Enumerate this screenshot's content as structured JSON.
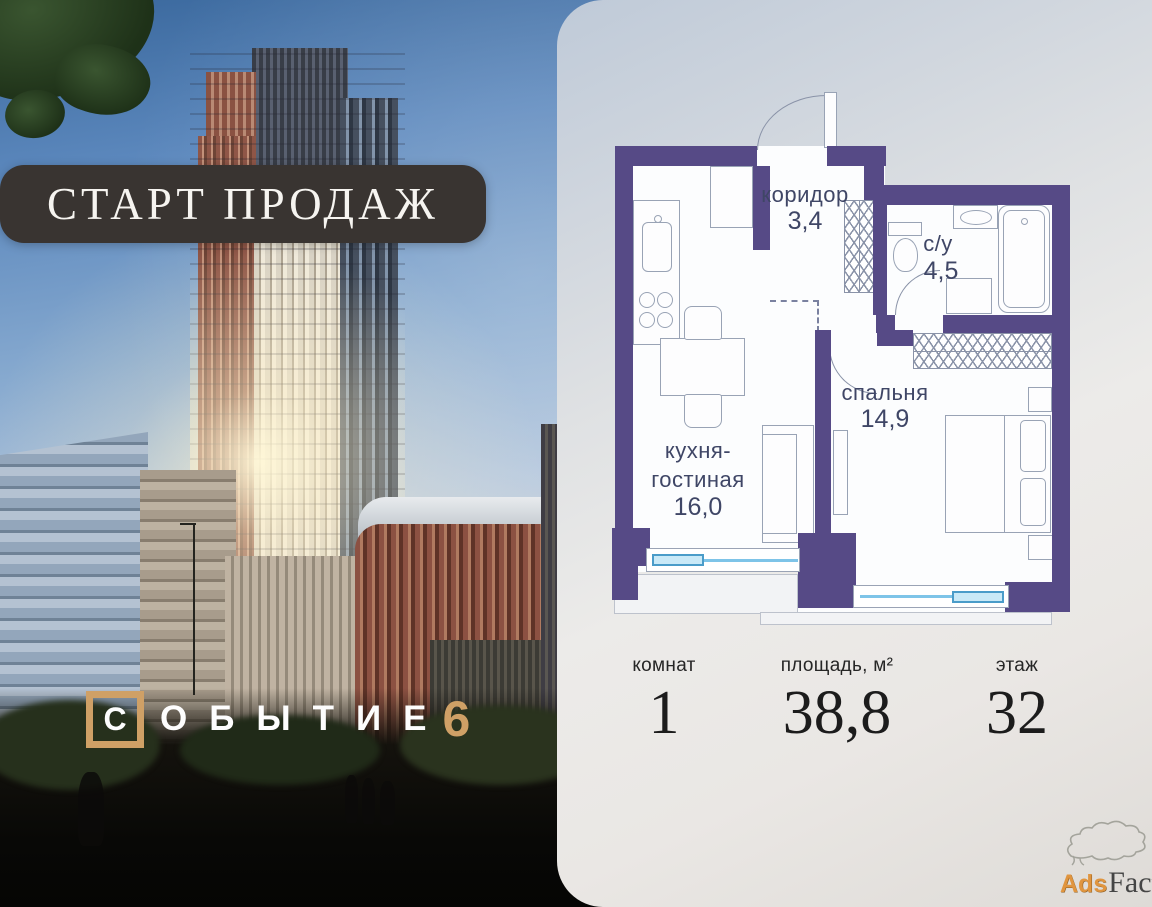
{
  "banner": {
    "text": "СТАРТ ПРОДАЖ"
  },
  "logo": {
    "first_letter": "С",
    "rest": "ОБЫТИЕ",
    "number": "6"
  },
  "floor_plan": {
    "rooms": {
      "corridor": {
        "name": "коридор",
        "area": "3,4"
      },
      "bathroom": {
        "name": "с/у",
        "area": "4,5"
      },
      "bedroom": {
        "name": "спальня",
        "area": "14,9"
      },
      "kitchen_living": {
        "line1": "кухня-",
        "line2": "гостиная",
        "area": "16,0"
      }
    }
  },
  "stats": {
    "rooms": {
      "label": "комнат",
      "value": "1"
    },
    "area": {
      "label": "площадь, м²",
      "value": "38,8"
    },
    "floor": {
      "label": "этаж",
      "value": "32"
    }
  },
  "watermark": {
    "ads": "Ads",
    "factory": "Factory",
    "icon": "factory-smoke-cloud"
  },
  "colors": {
    "plan_wall": "#564a86",
    "window_blue": "#7ec4e8",
    "accent_gold": "#cfa066",
    "banner_bg": "#393431",
    "label_text": "#3f4666"
  }
}
